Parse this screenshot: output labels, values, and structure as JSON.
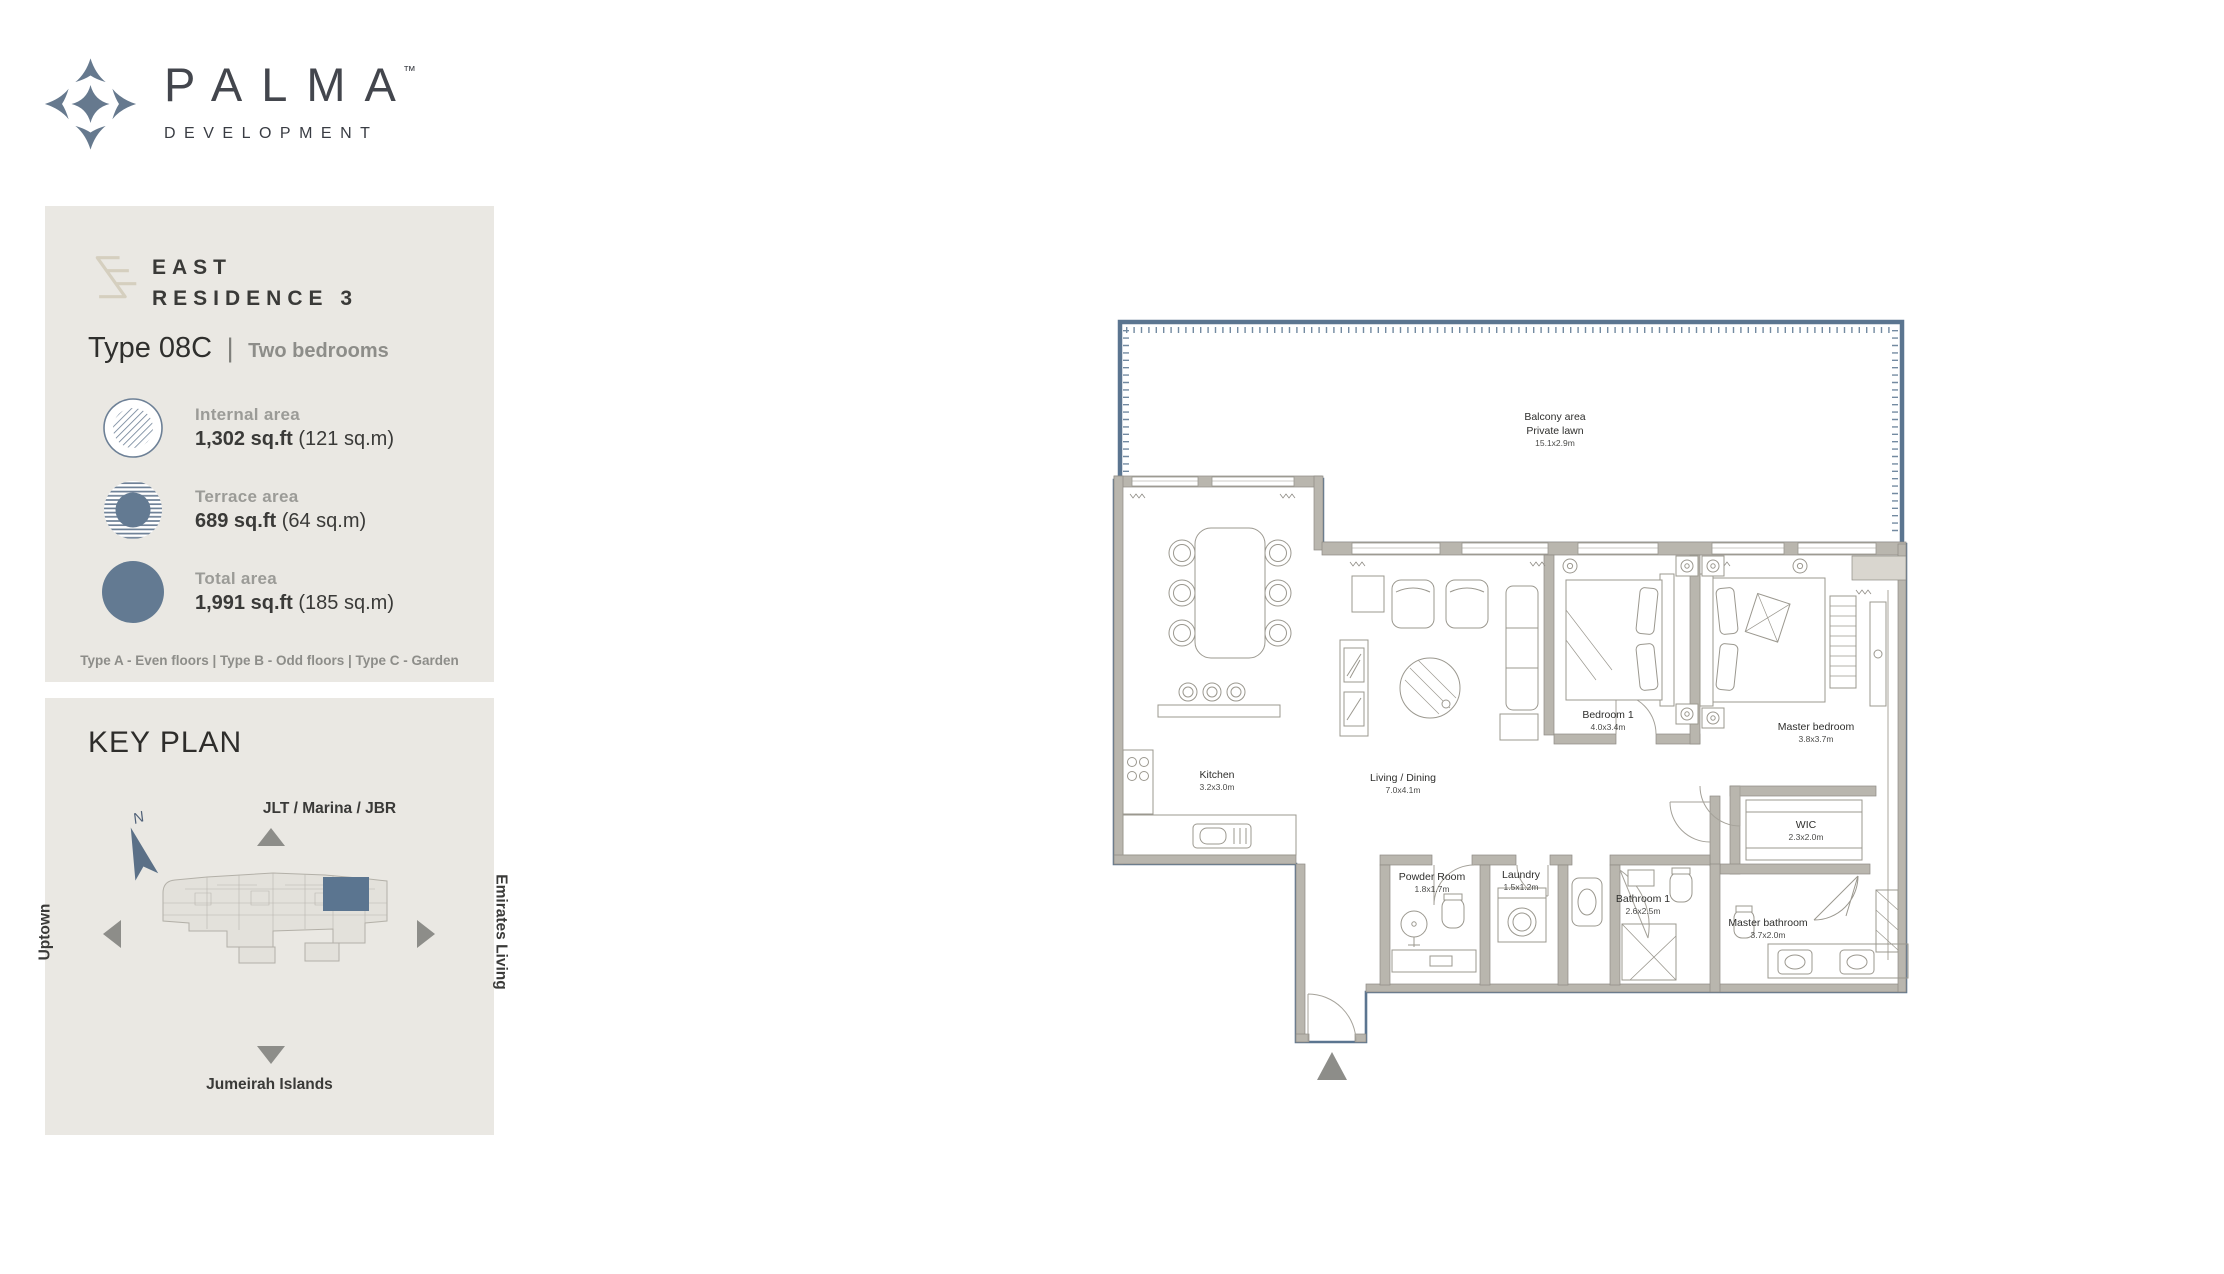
{
  "brand": {
    "name": "PALMA",
    "tm": "TM",
    "subtitle": "DEVELOPMENT"
  },
  "info_panel": {
    "project": "EAST",
    "residence": "RESIDENCE 3",
    "type_label": "Type 08C",
    "type_separator": "|",
    "bedrooms": "Two bedrooms",
    "areas": [
      {
        "id": "internal",
        "icon": "hatched-circle-icon",
        "label": "Internal area",
        "value": "1,302 sq.ft",
        "metric": "(121 sq.m)"
      },
      {
        "id": "terrace",
        "icon": "striped-circle-icon",
        "label": "Terrace area",
        "value": "689 sq.ft",
        "metric": "(64 sq.m)"
      },
      {
        "id": "total",
        "icon": "solid-circle-icon",
        "label": "Total area",
        "value": "1,991 sq.ft",
        "metric": "(185 sq.m)"
      }
    ],
    "floor_note": "Type A - Even floors | Type B - Odd floors | Type C - Garden"
  },
  "key_plan": {
    "title": "KEY PLAN",
    "north_label": "N",
    "directions": [
      {
        "id": "top",
        "label": "JLT / Marina / JBR"
      },
      {
        "id": "left",
        "label": "Uptown"
      },
      {
        "id": "right",
        "label": "Emirates Living"
      },
      {
        "id": "bottom",
        "label": "Jumeirah Islands"
      }
    ]
  },
  "floor_plan": {
    "rooms": [
      {
        "id": "balcony",
        "name": "Balcony area",
        "name2": "Private lawn",
        "dims": "15.1x2.9m"
      },
      {
        "id": "kitchen",
        "name": "Kitchen",
        "dims": "3.2x3.0m"
      },
      {
        "id": "living-dining",
        "name": "Living / Dining",
        "dims": "7.0x4.1m"
      },
      {
        "id": "bedroom-1",
        "name": "Bedroom 1",
        "dims": "4.0x3.4m"
      },
      {
        "id": "master-bedroom",
        "name": "Master bedroom",
        "dims": "3.8x3.7m"
      },
      {
        "id": "wic",
        "name": "WIC",
        "dims": "2.3x2.0m"
      },
      {
        "id": "powder-room",
        "name": "Powder Room",
        "dims": "1.8x1.7m"
      },
      {
        "id": "laundry",
        "name": "Laundry",
        "dims": "1.5x1.2m"
      },
      {
        "id": "bathroom-1",
        "name": "Bathroom 1",
        "dims": "2.6x2.5m"
      },
      {
        "id": "master-bathroom",
        "name": "Master bathroom",
        "dims": "3.7x2.0m"
      }
    ]
  },
  "colors": {
    "accent_slate": "#5b7590",
    "panel_bg": "#eae8e3",
    "wall_gray": "#b9b6ae",
    "text_dark": "#3a3a38",
    "text_gray": "#9b9b97",
    "triangle_gray": "#8d8d89",
    "mark_beige": "#d5cfbf"
  }
}
